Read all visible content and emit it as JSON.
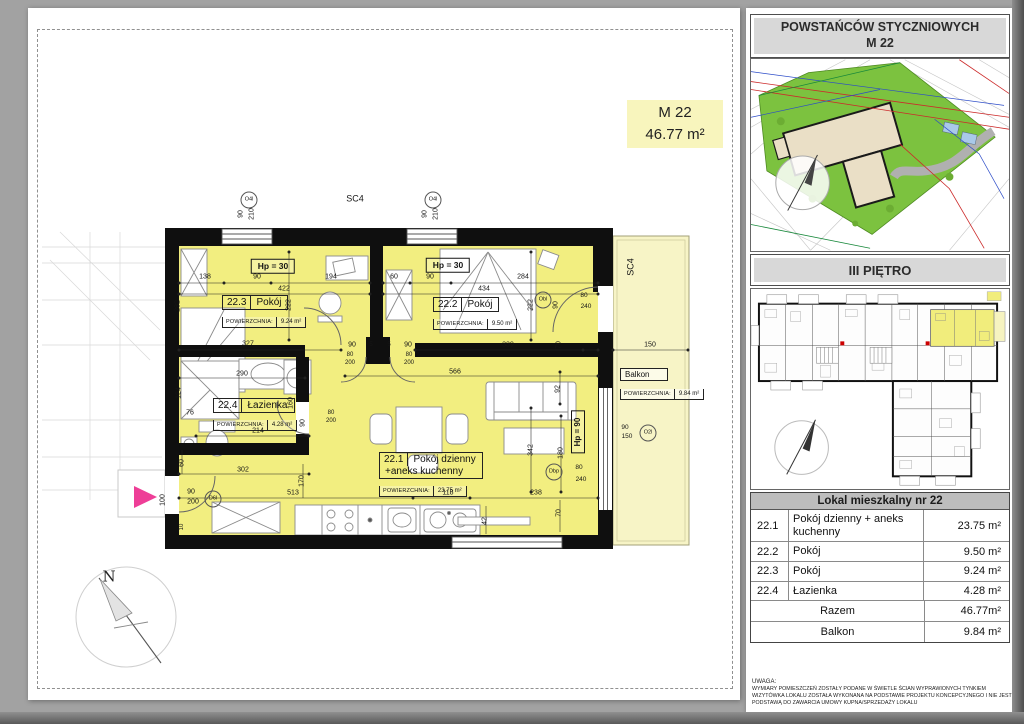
{
  "plan": {
    "badge": {
      "title": "M 22",
      "area": "46.77 m²"
    },
    "area_label": "POWIERZCHNIA:",
    "rooms": [
      {
        "id": "22.3",
        "name": "Pokój",
        "area": "9.24 m²"
      },
      {
        "id": "22.2",
        "name": "Pokój",
        "area": "9.50 m²"
      },
      {
        "id": "22.4",
        "name": "Łazienka",
        "area": "4.28 m²"
      },
      {
        "id": "22.1",
        "name": "Pokój dzienny",
        "name2": "+aneks kuchenny",
        "area": "23.75 m²"
      }
    ],
    "balcony": {
      "name": "Balkon",
      "area": "9.84 m²"
    },
    "colors": {
      "apartment_fill": "#f2ee80",
      "balcony_fill": "#f7f4c6",
      "entry_arrow": "#ee3e97"
    },
    "labels": [
      {
        "t": "SC4",
        "x": 355,
        "y": 199,
        "fs": 9
      },
      {
        "t": "O4l",
        "x": 249,
        "y": 200,
        "c": 1
      },
      {
        "t": "O4l",
        "x": 433,
        "y": 200,
        "c": 1
      },
      {
        "t": "90",
        "x": 241,
        "y": 214,
        "r": -90
      },
      {
        "t": "210",
        "x": 252,
        "y": 214,
        "r": -90
      },
      {
        "t": "90",
        "x": 425,
        "y": 214,
        "r": -90
      },
      {
        "t": "210",
        "x": 436,
        "y": 214,
        "r": -90
      },
      {
        "t": "SC4",
        "x": 631,
        "y": 267,
        "r": -90,
        "fs": 9
      },
      {
        "t": "Hp = 30",
        "x": 273,
        "y": 266,
        "b": 1
      },
      {
        "t": "Hp = 30",
        "x": 448,
        "y": 265,
        "b": 1
      },
      {
        "t": "138",
        "x": 205,
        "y": 277
      },
      {
        "t": "90",
        "x": 257,
        "y": 277
      },
      {
        "t": "422",
        "x": 284,
        "y": 289
      },
      {
        "t": "194",
        "x": 331,
        "y": 277
      },
      {
        "t": "282",
        "x": 178,
        "y": 306,
        "r": -90
      },
      {
        "t": "222",
        "x": 289,
        "y": 305,
        "r": -90
      },
      {
        "t": "327",
        "x": 248,
        "y": 344
      },
      {
        "t": "60",
        "x": 394,
        "y": 277
      },
      {
        "t": "90",
        "x": 430,
        "y": 277
      },
      {
        "t": "284",
        "x": 523,
        "y": 277
      },
      {
        "t": "434",
        "x": 484,
        "y": 289
      },
      {
        "t": "222",
        "x": 531,
        "y": 305,
        "r": -90
      },
      {
        "t": "90",
        "x": 556,
        "y": 305,
        "r": -90
      },
      {
        "t": "Obl",
        "x": 543,
        "y": 300,
        "c": 1
      },
      {
        "t": "80",
        "x": 584,
        "y": 296,
        "fs": 6.5
      },
      {
        "t": "240",
        "x": 586,
        "y": 307,
        "fs": 6.5
      },
      {
        "t": "339",
        "x": 508,
        "y": 345
      },
      {
        "t": "70",
        "x": 559,
        "y": 345,
        "r": -90
      },
      {
        "t": "90",
        "x": 352,
        "y": 345
      },
      {
        "t": "5",
        "x": 371,
        "y": 345,
        "fs": 6
      },
      {
        "t": "5",
        "x": 389,
        "y": 345,
        "fs": 6
      },
      {
        "t": "90",
        "x": 408,
        "y": 345
      },
      {
        "t": "80",
        "x": 350,
        "y": 355,
        "fs": 6
      },
      {
        "t": "200",
        "x": 350,
        "y": 363,
        "fs": 6
      },
      {
        "t": "80",
        "x": 409,
        "y": 355,
        "fs": 6
      },
      {
        "t": "200",
        "x": 409,
        "y": 363,
        "fs": 6
      },
      {
        "t": "566",
        "x": 455,
        "y": 372
      },
      {
        "t": "290",
        "x": 242,
        "y": 374
      },
      {
        "t": "124",
        "x": 179,
        "y": 393,
        "r": -90
      },
      {
        "t": "76",
        "x": 190,
        "y": 413
      },
      {
        "t": "160",
        "x": 291,
        "y": 403,
        "r": -90
      },
      {
        "t": "214",
        "x": 258,
        "y": 431
      },
      {
        "t": "90",
        "x": 303,
        "y": 423,
        "r": -90
      },
      {
        "t": "80",
        "x": 331,
        "y": 413,
        "fs": 6
      },
      {
        "t": "200",
        "x": 331,
        "y": 421,
        "fs": 6
      },
      {
        "t": "92",
        "x": 558,
        "y": 389,
        "r": -90
      },
      {
        "t": "Hp = 90",
        "x": 578,
        "y": 432,
        "r": -90,
        "b": 1,
        "fs": 8
      },
      {
        "t": "80",
        "x": 579,
        "y": 468,
        "fs": 6.5
      },
      {
        "t": "240",
        "x": 581,
        "y": 480,
        "fs": 6.5
      },
      {
        "t": "Dbp",
        "x": 554,
        "y": 472,
        "c": 1
      },
      {
        "t": "342",
        "x": 531,
        "y": 450,
        "r": -90
      },
      {
        "t": "180",
        "x": 561,
        "y": 453,
        "r": -90
      },
      {
        "t": "60",
        "x": 182,
        "y": 463,
        "r": -90
      },
      {
        "t": "302",
        "x": 243,
        "y": 470
      },
      {
        "t": "100",
        "x": 163,
        "y": 500,
        "r": -90
      },
      {
        "t": "90",
        "x": 191,
        "y": 492
      },
      {
        "t": "200",
        "x": 193,
        "y": 502
      },
      {
        "t": "D6l",
        "x": 213,
        "y": 499,
        "c": 1
      },
      {
        "t": "513",
        "x": 293,
        "y": 493
      },
      {
        "t": "170",
        "x": 302,
        "y": 481,
        "r": -90
      },
      {
        "t": "10",
        "x": 182,
        "y": 527,
        "r": -90,
        "fs": 6
      },
      {
        "t": "118",
        "x": 448,
        "y": 493
      },
      {
        "t": "238",
        "x": 536,
        "y": 493
      },
      {
        "t": "42",
        "x": 485,
        "y": 521,
        "r": -90
      },
      {
        "t": "70",
        "x": 559,
        "y": 513,
        "r": -90
      },
      {
        "t": "150",
        "x": 650,
        "y": 345
      },
      {
        "t": "90",
        "x": 625,
        "y": 428,
        "fs": 6.5
      },
      {
        "t": "150",
        "x": 627,
        "y": 437,
        "fs": 6.5
      },
      {
        "t": "O2l",
        "x": 648,
        "y": 433,
        "c": 1
      },
      {
        "t": "N",
        "x": 109,
        "y": 577,
        "cls": "north",
        "fs": 15
      },
      {
        "t": "N",
        "x": 799,
        "y": 161,
        "cls": "north",
        "fs": 10
      },
      {
        "t": "N",
        "x": 790,
        "y": 421,
        "cls": "north",
        "fs": 11
      }
    ]
  },
  "sidebar": {
    "header": {
      "line1": "POWSTAŃCÓW STYCZNIOWYCH",
      "line2": "M 22"
    },
    "floor_header": "III PIĘTRO",
    "table": {
      "title": "Lokal mieszkalny nr 22",
      "rows": [
        {
          "no": "22.1",
          "name": "Pokój dzienny + aneks kuchenny",
          "area": "23.75 m²"
        },
        {
          "no": "22.2",
          "name": "Pokój",
          "area": "9.50 m²"
        },
        {
          "no": "22.3",
          "name": "Pokój",
          "area": "9.24 m²"
        },
        {
          "no": "22.4",
          "name": "Łazienka",
          "area": "4.28 m²"
        }
      ],
      "summary": [
        {
          "name": "Razem",
          "area": "46.77m²"
        },
        {
          "name": "Balkon",
          "area": "9.84 m²"
        }
      ]
    },
    "disclaimer": {
      "title": "UWAGA:",
      "lines": [
        "WYMIARY POMIESZCZEŃ ZOSTAŁY PODANE W ŚWIETLE ŚCIAN WYPRAWIONYCH TYNKIEM",
        "WIZYTÓWKA LOKALU ZOSTAŁA WYKONANA NA PODSTAWIE PROJEKTU KONCEPCYJNEGO I NIE JEST",
        "PODSTAWĄ DO ZAWARCIA UMOWY KUPNA/SPRZEDAŻY LOKALU"
      ]
    }
  }
}
